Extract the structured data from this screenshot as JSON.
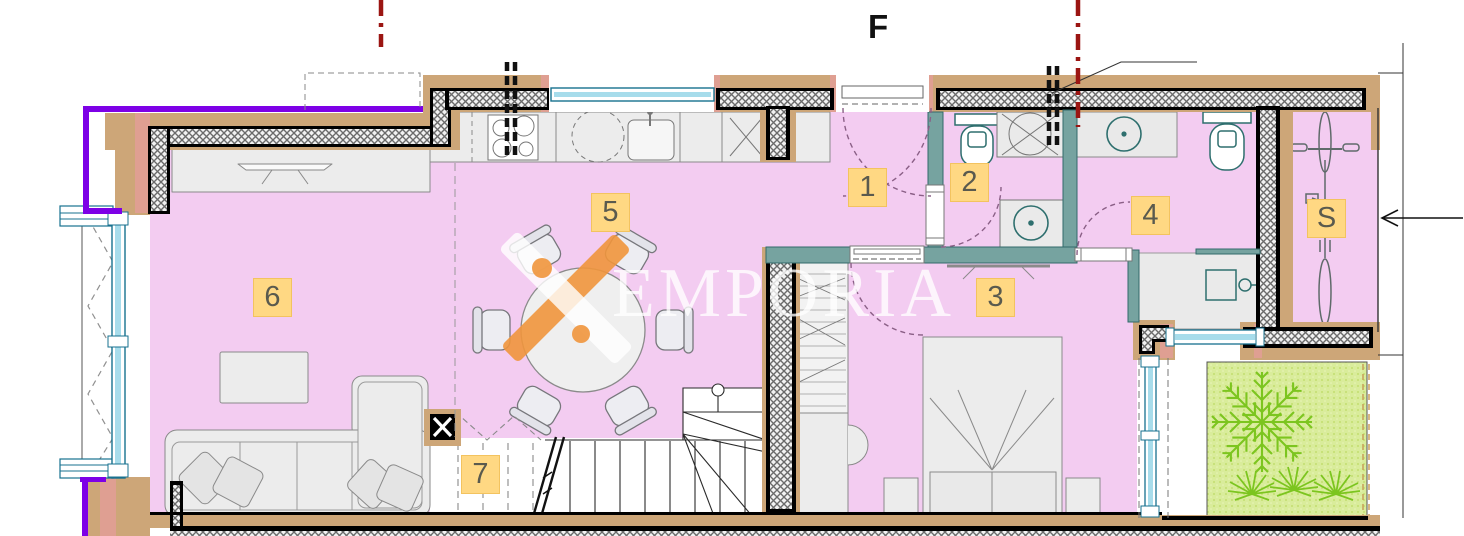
{
  "plan": {
    "facade_label": "F",
    "watermark": {
      "text": "EMPORIA"
    },
    "rooms": [
      {
        "id": "entry-hall",
        "label": "1"
      },
      {
        "id": "toilet-room",
        "label": "2"
      },
      {
        "id": "bedroom",
        "label": "3"
      },
      {
        "id": "bathroom",
        "label": "4"
      },
      {
        "id": "kitchen-dining",
        "label": "5"
      },
      {
        "id": "living-room",
        "label": "6"
      },
      {
        "id": "stairs-area",
        "label": "7"
      },
      {
        "id": "storage",
        "label": "S"
      }
    ],
    "colors": {
      "room_fill": "#f3ccf1",
      "wall_tan": "#cda678",
      "wall_salmon": "#df9f92",
      "interior_wall_teal": "#76a3a0",
      "window_frame": "#17718f",
      "label_bg": "#ffd883",
      "accent_purple": "#7d00e6",
      "section_line_red": "#9b1512",
      "garden_green": "#d9ec9b",
      "plant_green": "#7cc51f",
      "watermark_orange": "#f0953c"
    }
  }
}
